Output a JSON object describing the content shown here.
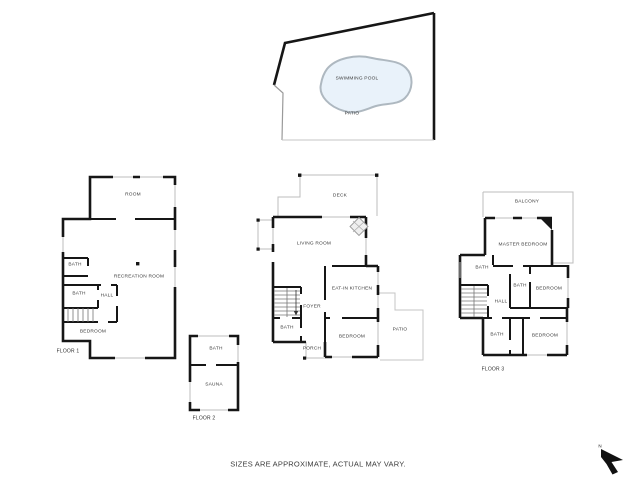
{
  "site": {
    "swimming_pool": "SWIMMING POOL",
    "patio": "PATIO"
  },
  "floor1": {
    "title": "FLOOR 1",
    "rooms": {
      "room": "ROOM",
      "recreation_room": "RECREATION ROOM",
      "bath_upper": "BATH",
      "bath_lower": "BATH",
      "hall": "HALL",
      "bedroom": "BEDROOM"
    }
  },
  "floor2": {
    "title": "FLOOR 2",
    "main": {
      "deck": "DECK",
      "living_room": "LIVING ROOM",
      "eat_in_kitchen": "EAT-IN KITCHEN",
      "foyer": "FOYER",
      "bath": "BATH",
      "bedroom": "BEDROOM",
      "porch": "PORCH",
      "patio": "PATIO"
    },
    "annex": {
      "bath": "BATH",
      "sauna": "SAUNA"
    }
  },
  "floor3": {
    "title": "FLOOR 3",
    "rooms": {
      "balcony": "BALCONY",
      "master_bedroom": "MASTER BEDROOM",
      "bath_left": "BATH",
      "bath_middle": "BATH",
      "bedroom_upper": "BEDROOM",
      "hall": "HALL",
      "bath_lower": "BATH",
      "bedroom_lower": "BEDROOM"
    }
  },
  "footer": {
    "disclaimer": "SIZES ARE APPROXIMATE, ACTUAL MAY VARY."
  },
  "compass": {
    "north": "N"
  },
  "colors": {
    "wall": "#161616",
    "thin_line": "#bcbcbc",
    "pool_fill": "#e9f2fa",
    "pool_outline": "#aeb8c0",
    "background": "#ffffff",
    "label_text": "#3a3a3a"
  }
}
